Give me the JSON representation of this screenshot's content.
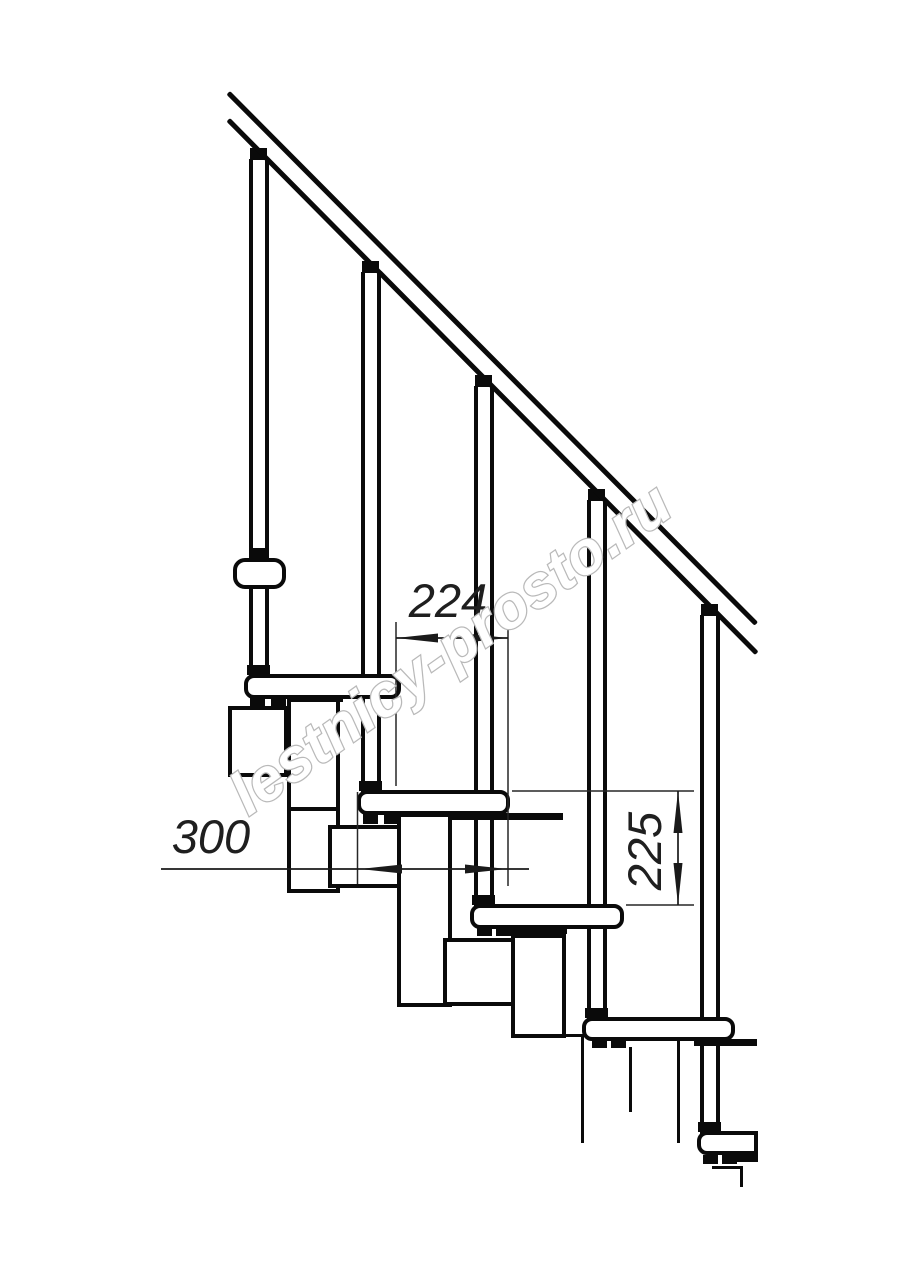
{
  "watermark": {
    "text": "lestnicy-prosto.ru",
    "color": "#b9b9b9"
  },
  "dimensions": {
    "step_run": {
      "value": "224"
    },
    "tread_length": {
      "value": "300"
    },
    "step_rise": {
      "value": "225"
    }
  },
  "colors": {
    "background": "#ffffff",
    "drawing_line": "#0a0a0a",
    "dimension_line": "#262626",
    "dimension_text": "#1f1f1f"
  }
}
